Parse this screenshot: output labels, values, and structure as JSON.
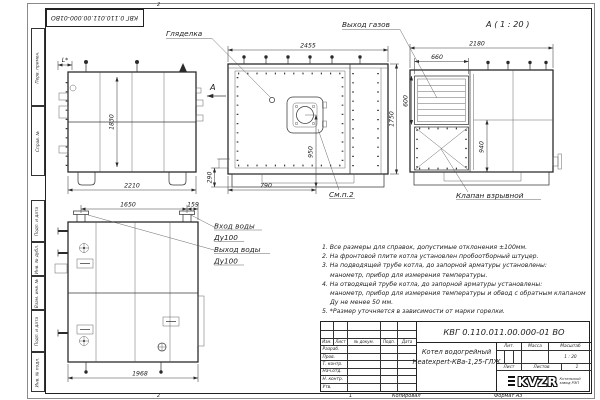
{
  "frame": {
    "stamp_rotated": "КВГ 0.110.011.00.000-01ВО",
    "columns": [
      "Перв. примен.",
      "Справ. №",
      "Подп. и дата",
      "Инв. № дубл.",
      "Взам. инв. №",
      "Подп. и дата",
      "Инв. № подл."
    ],
    "zone_top": "2",
    "zone_bottom": "2",
    "copy_zone": "1",
    "copied_label": "Копировал",
    "format_label": "Формат А3"
  },
  "views": {
    "labels": {
      "glyadelka": "Гляделка",
      "vykhod_gazov": "Выход газов",
      "view_a_title": "А ( 1 : 20 )",
      "klapan_vzryvnoy": "Клапан взрывной",
      "sm_p2": "См.п.2",
      "vkhod_vody": "Вход воды",
      "vykhod_vody": "Выход воды",
      "du100_in": "Ду100",
      "du100_out": "Ду100",
      "section_a": "А"
    },
    "dims": {
      "side_height": "1830",
      "side_width": "2210",
      "side_asterisk": "L*",
      "front_width": "2455",
      "front_height": "1750",
      "burner_height": "950",
      "burner_offset": "790",
      "stub_height": "290",
      "rear_width": "2180",
      "gas_outlet_width": "660",
      "gas_outlet_height": "600",
      "rear_right_height": "940",
      "plan_pipe_span": "1650",
      "plan_pipe_edge": "159",
      "plan_width": "1968"
    }
  },
  "notes": [
    "1. Все размеры для справок, допустимые отклонения ±100мм.",
    "2. На фронтовой плите котла установлен пробоотборный штуцер.",
    "3. На подводящей трубе котла, до запорной арматуры установлены:",
    "манометр, прибор для измерения температуры.",
    "4. На отводящей трубе котла, до запорной арматуры установлены:",
    "манометр, прибор для измерения температуры и обвод с обратным клапаном",
    "Ду не менее 50 мм.",
    "5. *Размер уточняется в зависимости от марки горелки."
  ],
  "title_block": {
    "doc_number": "КВГ 0.110.011.00.000-01 ВО",
    "name_line1": "Котел водогрейный",
    "name_line2": "Heatexpert-КВа-1,25-ГЛЖ",
    "col_izm": "Изм.",
    "col_list": "Лист",
    "col_docnum": "№ докум.",
    "col_podp": "Подп.",
    "col_data": "Дата",
    "rows": [
      "Разраб.",
      "Пров.",
      "Т. контр.",
      "Нач.отд.",
      "Н. контр.",
      "Утв."
    ],
    "lit": "Лит.",
    "mass": "Масса",
    "scale_label": "Масштаб",
    "scale": "1 : 20",
    "sheet": "Лист",
    "sheets": "Листов",
    "sheets_count": "1",
    "logo": "KVZR",
    "logo_caption1": "Котельный",
    "logo_caption2": "завод РЭП",
    "copied": "Копировал",
    "format": "Формат А3"
  }
}
